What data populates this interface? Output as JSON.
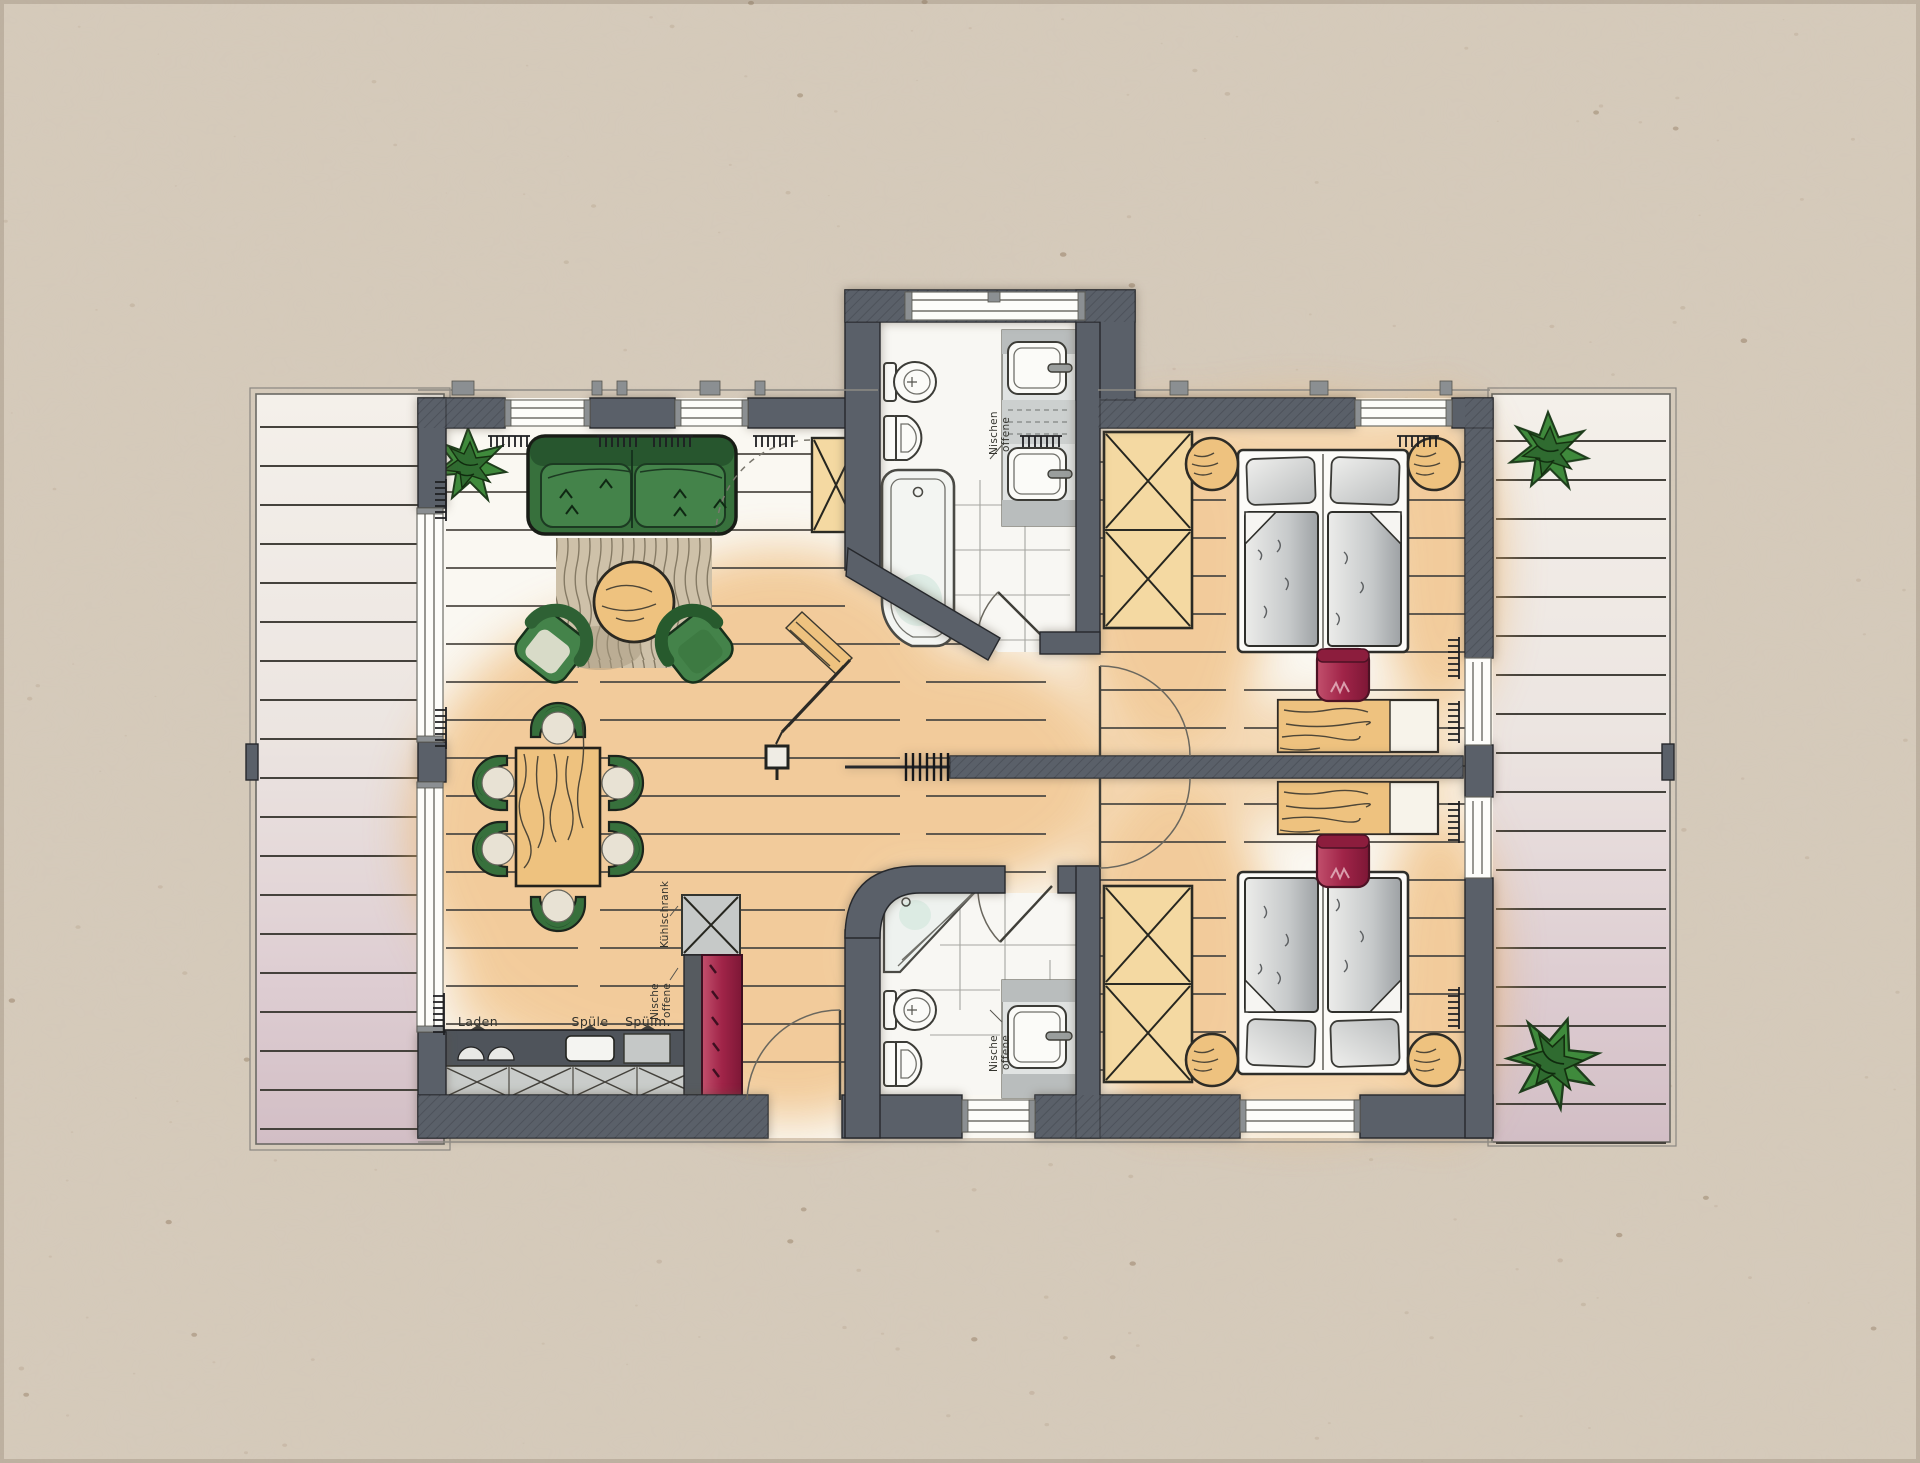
{
  "document": {
    "kind": "hand-drawn watercolor apartment floor plan on kraft paper",
    "rooms_visible": "living-dining room with kitchen, corridor, two bathrooms, two bedrooms, two terraces"
  },
  "labels": {
    "laden": "Laden",
    "spuele": "Spüle",
    "spuelmaschine": "Spülm.",
    "kuehlschrank": "Kühlschrank",
    "offene": "offene",
    "nische": "Nische",
    "nischen": "Nischen"
  },
  "colors": {
    "paper": "#d5cabb",
    "floor": "#faf8f2",
    "wall": "#5a6069",
    "wallLine": "#26282c",
    "wood": "#eec27f",
    "woodDark": "#3c3930",
    "woodLight": "#f4d9a2",
    "green": "#37703c",
    "greenDark": "#24512c",
    "red": "#a02448",
    "gray": "#c7cac9",
    "grayDark": "#8e9397",
    "duvet": "#b9bcbe",
    "rug": "#cec1a9",
    "plank": "#4e4a44",
    "orange": "#edb166",
    "aqua": "#d8eae1",
    "label": "#33332d"
  }
}
